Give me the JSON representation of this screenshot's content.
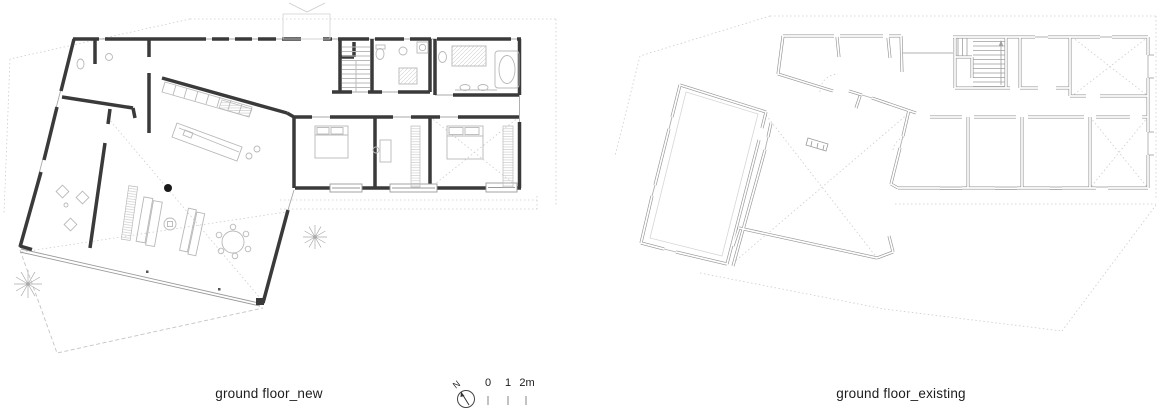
{
  "plans": {
    "new": {
      "caption": "ground floor_new"
    },
    "existing": {
      "caption": "ground floor_existing"
    }
  },
  "legend": {
    "north_label": "N",
    "scale_tick_labels": [
      "0",
      "1",
      "2m"
    ]
  },
  "colors": {
    "wall_new": "#3a3a3a",
    "wall_existing": "#949494",
    "furniture": "#b8b8b8",
    "reference_dotted": "#cccccc",
    "text": "#1c1c1c"
  }
}
